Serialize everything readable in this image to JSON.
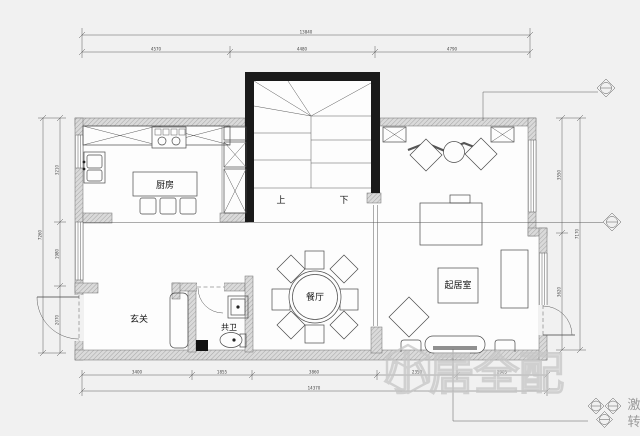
{
  "rooms": {
    "kitchen": "厨房",
    "entry": "玄关",
    "bath": "共卫",
    "dining": "餐厅",
    "living": "起居室"
  },
  "stairs": {
    "up": "上",
    "down": "下"
  },
  "dimensions": {
    "top": {
      "total": "13840",
      "segments": [
        "4570",
        "4480",
        "4790"
      ]
    },
    "bottom": {
      "total": "14370",
      "segments": [
        "3400",
        "1855",
        "3860",
        "2350",
        "2905"
      ]
    },
    "left": {
      "total": "7260",
      "segments": [
        "3210",
        "1980",
        "2070"
      ]
    },
    "right": {
      "total": "7170",
      "segments": [
        "3550",
        "3620"
      ]
    }
  },
  "watermark": {
    "logo": "house-cube-icon",
    "text": "小居全配"
  },
  "edge_text": [
    "激",
    "转"
  ],
  "colors": {
    "background": "#f1f1f1",
    "floor": "#fdfdfd",
    "wall_fill": "#d9d9d9",
    "stair_wall": "#1a1a1a",
    "line": "#3c3c3c",
    "watermark": "#c8c8c8"
  }
}
